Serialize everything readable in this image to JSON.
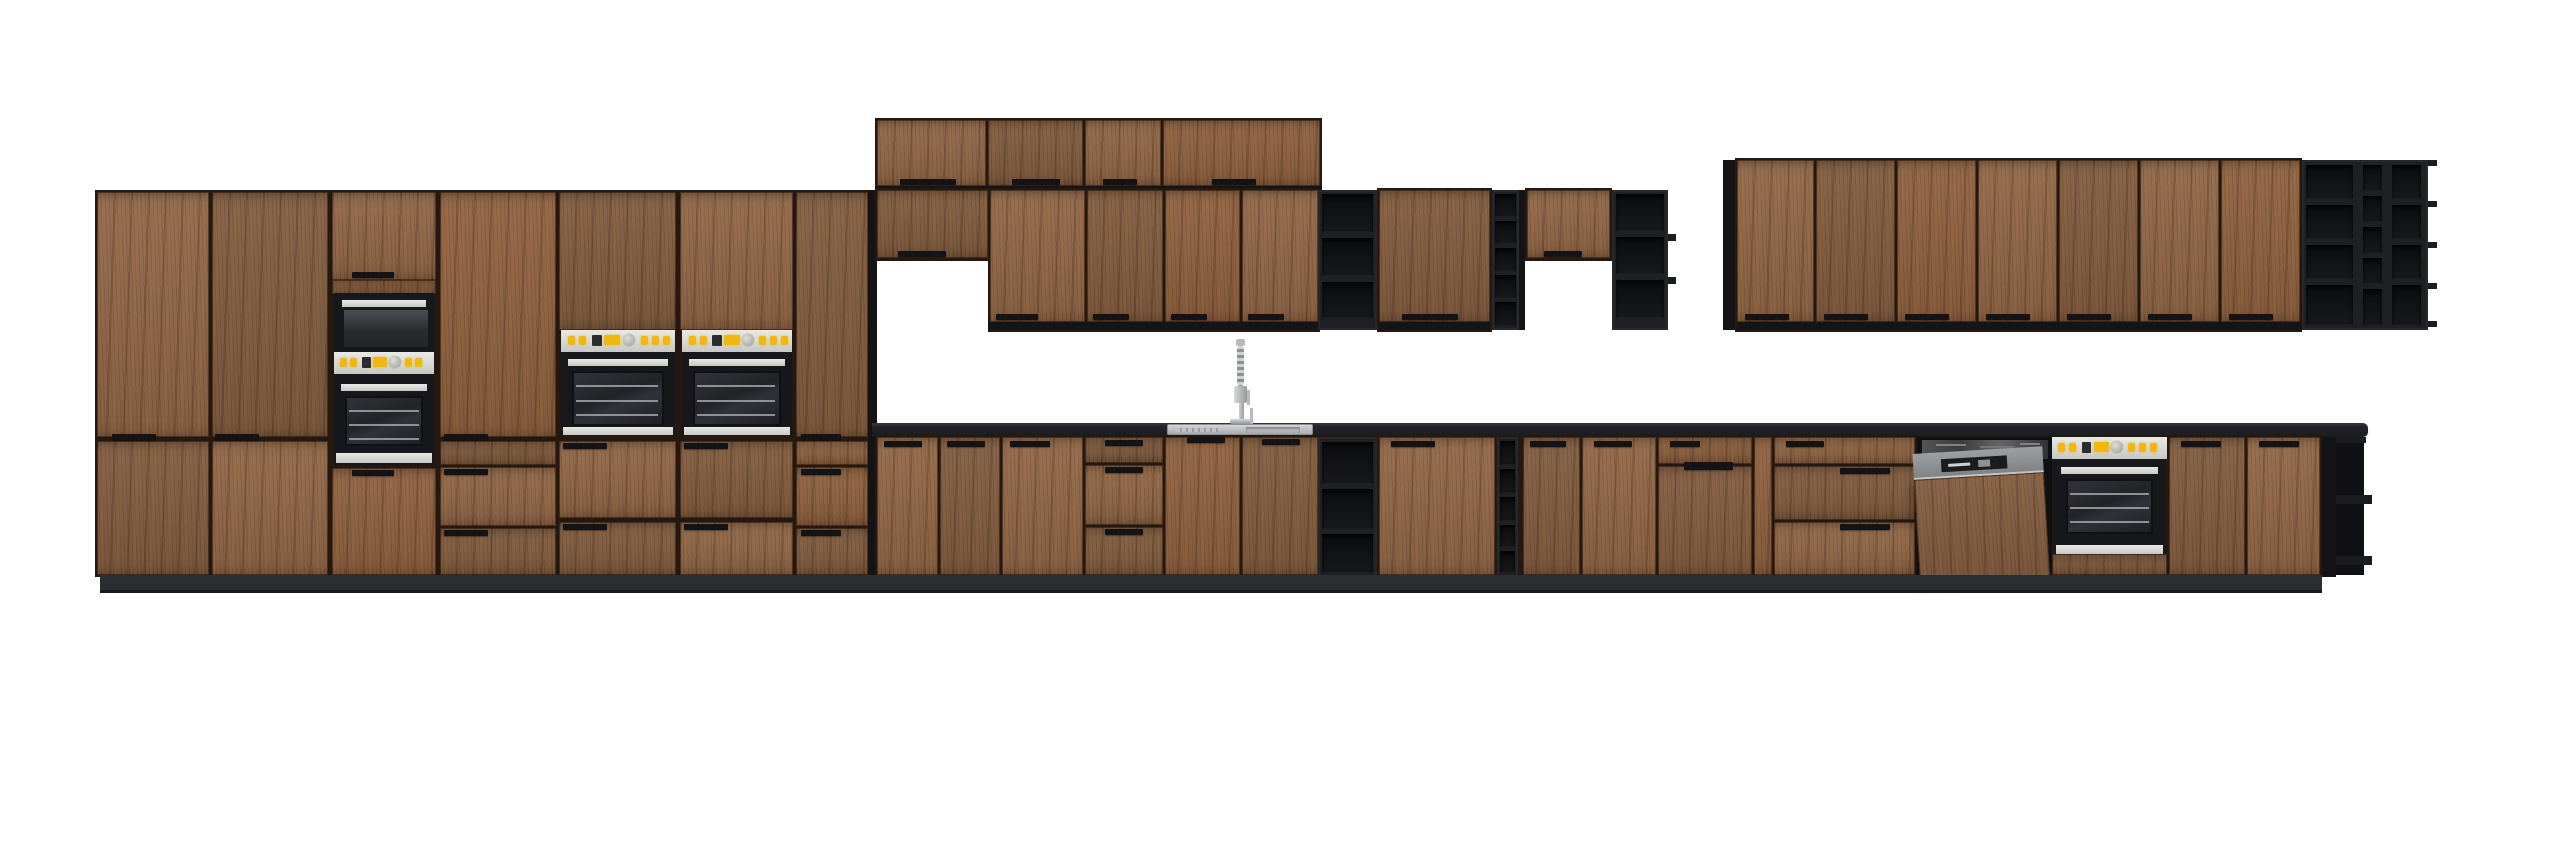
{
  "labels": {
    "scene": "Elevation render of a modular kitchen furniture set with dark wood fronts and black accents",
    "tall_section": "Tall cabinet wall with built-in microwave tower and two double oven towers",
    "stacked_row": "Stacked top wall cabinet row",
    "wall_row": "Wall cabinet row above sink with black open shelves, bottle rack and bridge niche",
    "right_upper_block": "Right wall cabinet run ending in black open corner shelf",
    "base_row": "Base cabinet run with sink, dishwasher and built-under oven",
    "countertop": "Dark worktop",
    "plinth": "Recessed dark plinth"
  },
  "palette": {
    "bg": "#ffffff",
    "wood_base": "#8a6345",
    "frame": "#241810",
    "black_unit": "#1e2023",
    "cubby": "#101114",
    "underside": "#141518",
    "side_panel": "#141417",
    "counter": "#1e1f23",
    "plinth": "#2c2d30",
    "plinth_edge": "#18191b",
    "handle": "#141416",
    "silver": "#d9d9d5",
    "steel": "#b7b9bb",
    "accent": "#f2b70d",
    "oven_black": "#17181b",
    "glass": "#26282c",
    "rack": "#a9abae",
    "dw_grey": "#8f9193",
    "sink_steel": "#c6c8ca"
  },
  "inventory": {
    "tall_cabinet_doors": 7,
    "built_in_ovens": 3,
    "microwave": 1,
    "stacked_top_doors": 4,
    "wall_doors": 14,
    "black_open_shelf_units": 4,
    "black_bottle_racks": 2,
    "black_corner_shelves": 2,
    "base_doors": 11,
    "drawer_stacks": 5,
    "dishwasher": 1,
    "built_under_oven": 1,
    "sink_with_tall_faucet": 1
  }
}
